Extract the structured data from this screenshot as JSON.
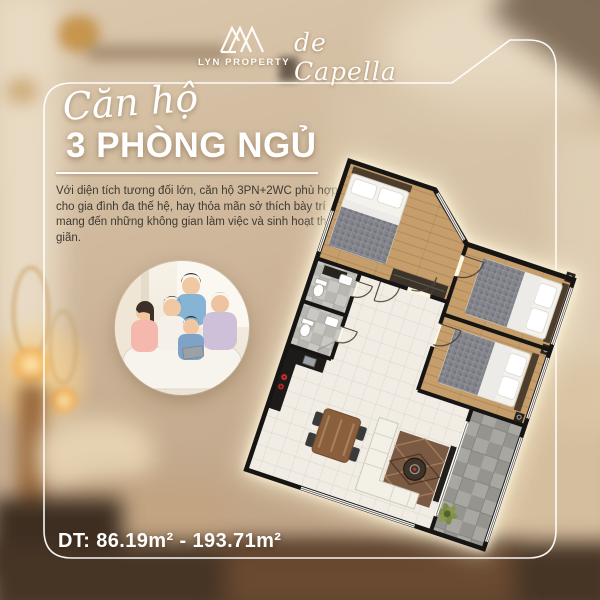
{
  "brand": {
    "monogram": "LYN",
    "name": "LYN PROPERTY"
  },
  "project": {
    "name": "de Capella"
  },
  "headline": {
    "script": "Căn hộ",
    "main": "3 PHÒNG NGỦ"
  },
  "description": {
    "text": "Với diện tích tương đối lớn, căn hộ 3PN+2WC phù hợp cho gia đình đa thế hệ, hay thỏa mãn sở thích bày trí mang đến những không gian làm việc và sinh hoạt thư giãn."
  },
  "area": {
    "text": "DT: 86.19m² - 193.71m²"
  },
  "photo": {
    "subject": "Multi-generation family of five seated on a sofa"
  },
  "floor_plan": {
    "description": "Rotated top-view rendering of a 3-bedroom apartment (3PN+2WC)",
    "rooms": [
      "master-bedroom",
      "bedroom-2",
      "bedroom-3",
      "bathroom-1",
      "bathroom-2",
      "kitchen",
      "dining-area",
      "living-room",
      "hallway",
      "balcony"
    ],
    "colors": {
      "walls": "#171513",
      "wood_floor": "#c59e6b",
      "tile_floor": "#f1ede4",
      "bath_tile": "#c6c5bf",
      "balcony_tile": "#a9a7a1",
      "bed_blanket": "#82828a",
      "rug": "#7b5a43"
    }
  },
  "colors": {
    "frame": "#ffffff",
    "text_light": "#ffffff",
    "text_dark": "#3e3a33",
    "background_warm": "#c9b196"
  }
}
